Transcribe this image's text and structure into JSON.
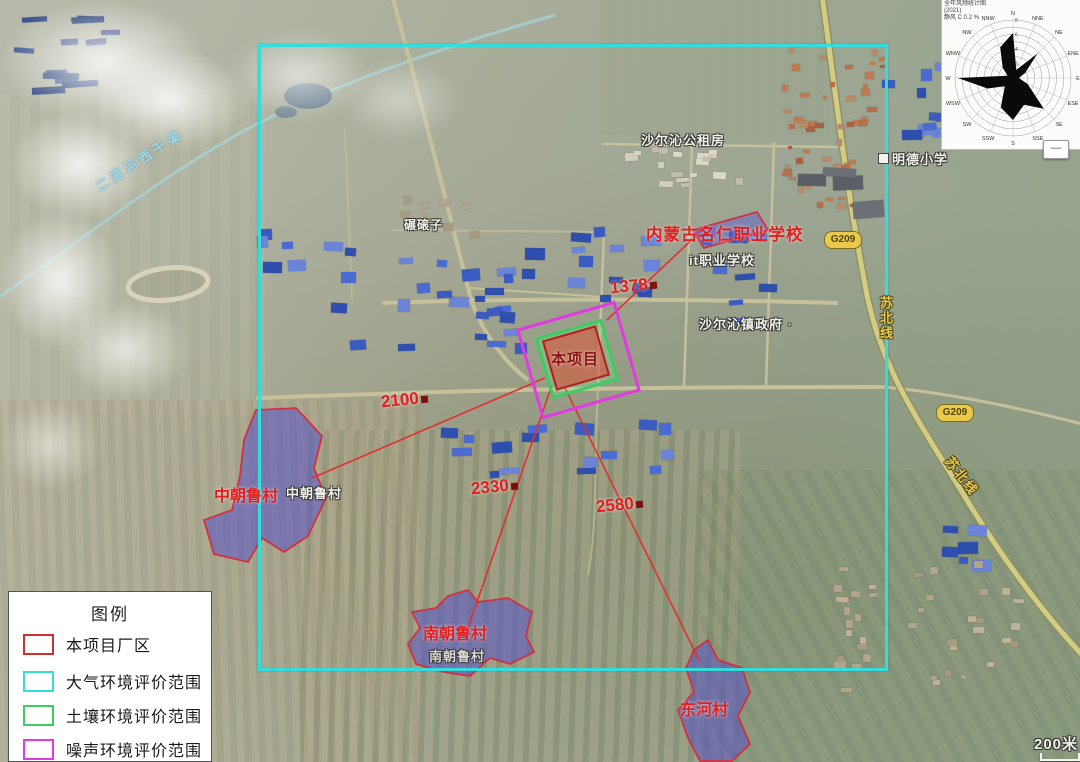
{
  "map": {
    "project_label": "本项目",
    "distance_labels": [
      "2100",
      "2330",
      "2580",
      "1378"
    ],
    "village_labels": {
      "zhongchaolu_red": "中朝鲁村",
      "zhongchaolu_base": "中朝鲁村",
      "nanchaolu_red": "南朝鲁村",
      "nanchaolu_base": "南朝鲁村",
      "donghe_red": "东河村"
    },
    "poi_labels": {
      "vocational_school": "内蒙古名仁职业学校",
      "it_school": "it职业学校",
      "public_housing": "沙尔沁公租房",
      "mingde_school": "明德小学",
      "town_government": "沙尔沁镇政府 ·",
      "niangunzi": "碾磙子",
      "canal": "二道河西干渠"
    },
    "road_labels": {
      "g209": "G209",
      "subei_line": "苏北线"
    },
    "scale_text": "200米",
    "colors": {
      "project_boundary": "#cf2e2e",
      "air_boundary": "#35dcdc",
      "soil_boundary": "#3ecb62",
      "noise_boundary": "#e23ae2",
      "village_fill": "#5a55c8",
      "guide_line": "#e03030"
    }
  },
  "legend": {
    "title": "图例",
    "items": [
      {
        "label": "本项目厂区",
        "color": "#cf2e2e"
      },
      {
        "label": "大气环境评价范围",
        "color": "#35dcdc"
      },
      {
        "label": "土壤环境评价范围",
        "color": "#3ecb62"
      },
      {
        "label": "噪声环境评价范围",
        "color": "#e23ae2"
      }
    ]
  },
  "wind_rose": {
    "type": "radar",
    "title_lines": [
      "全年风频统计图",
      "(2021)",
      "静风 C 0.2 %"
    ],
    "directions": [
      "N",
      "NNE",
      "NE",
      "ENE",
      "E",
      "ESE",
      "SE",
      "SSE",
      "S",
      "SSW",
      "SW",
      "WSW",
      "W",
      "WNW",
      "NW",
      "NNW"
    ],
    "values": [
      6.2,
      1.2,
      4.8,
      1.8,
      0.8,
      2.2,
      6.0,
      4.0,
      5.8,
      4.4,
      1.6,
      3.8,
      7.6,
      0.8,
      2.0,
      4.6
    ],
    "max": 8,
    "ring_labels": [
      2,
      4,
      6,
      8
    ]
  },
  "controls": {
    "collapse_button": "—"
  }
}
